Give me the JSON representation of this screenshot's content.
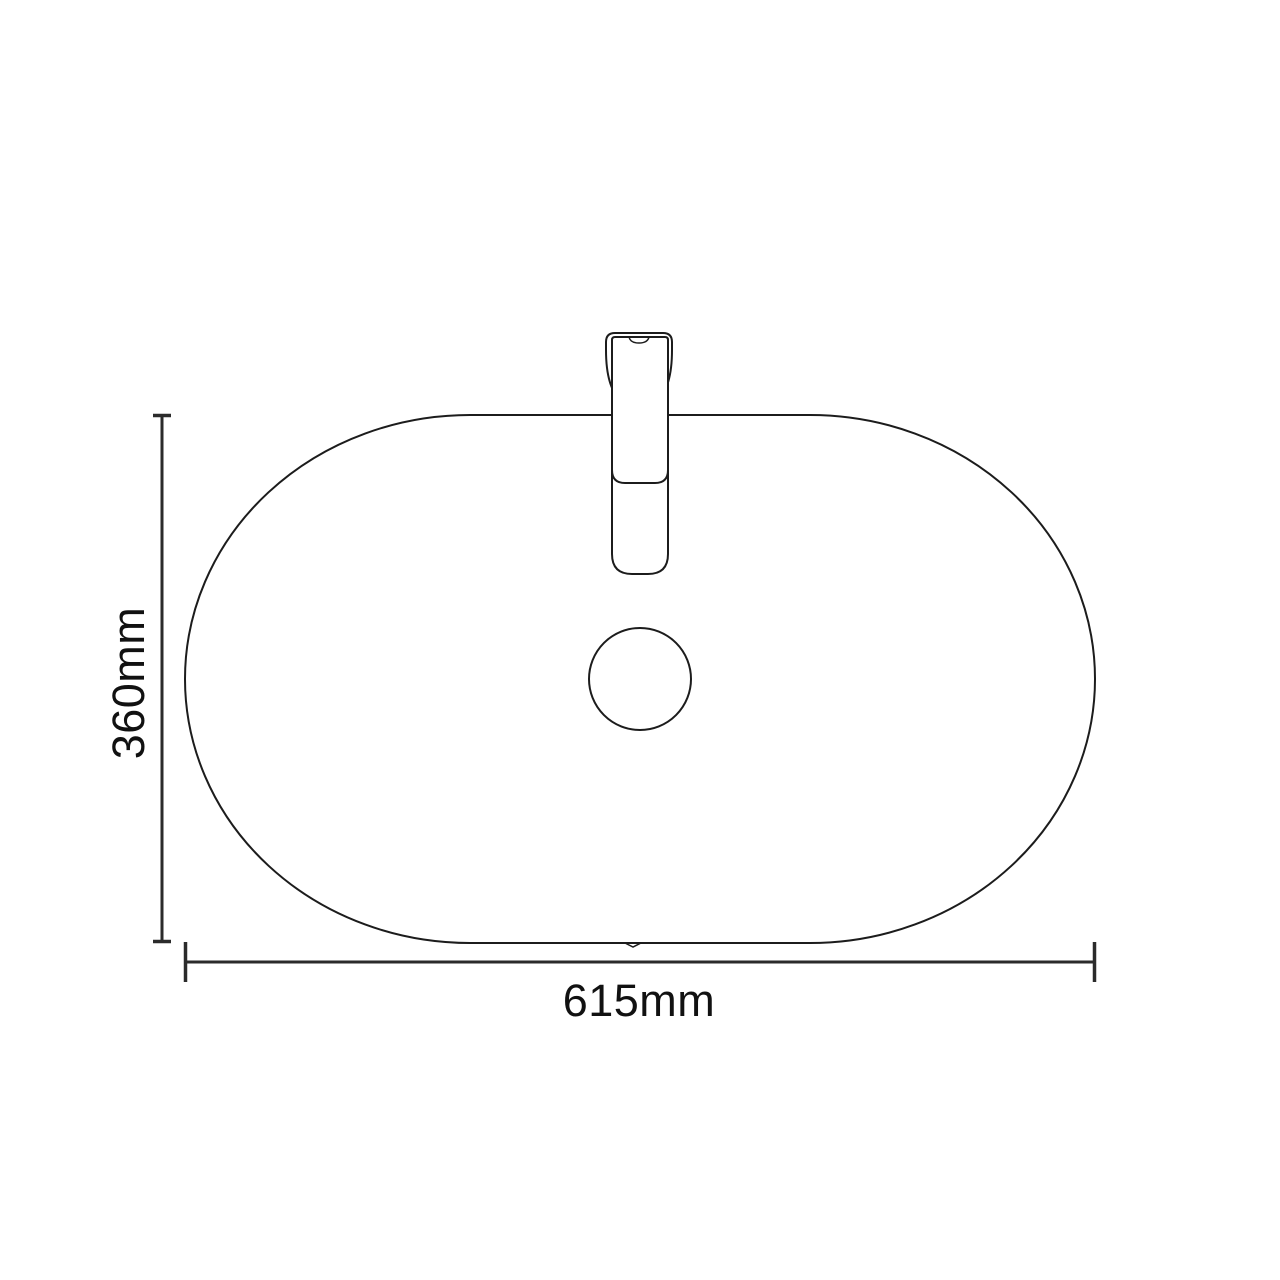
{
  "drawing": {
    "type": "technical-drawing-top-view",
    "subject": "oval-basin-with-mixer-tap",
    "background_color": "#ffffff",
    "outline_color": "#1c1c1c",
    "dimension_line_color": "#2b2b2b",
    "text_color": "#111111",
    "height_dimension": {
      "label": "360mm",
      "value_mm": 360
    },
    "width_dimension": {
      "label": "615mm",
      "value_mm": 615
    }
  }
}
